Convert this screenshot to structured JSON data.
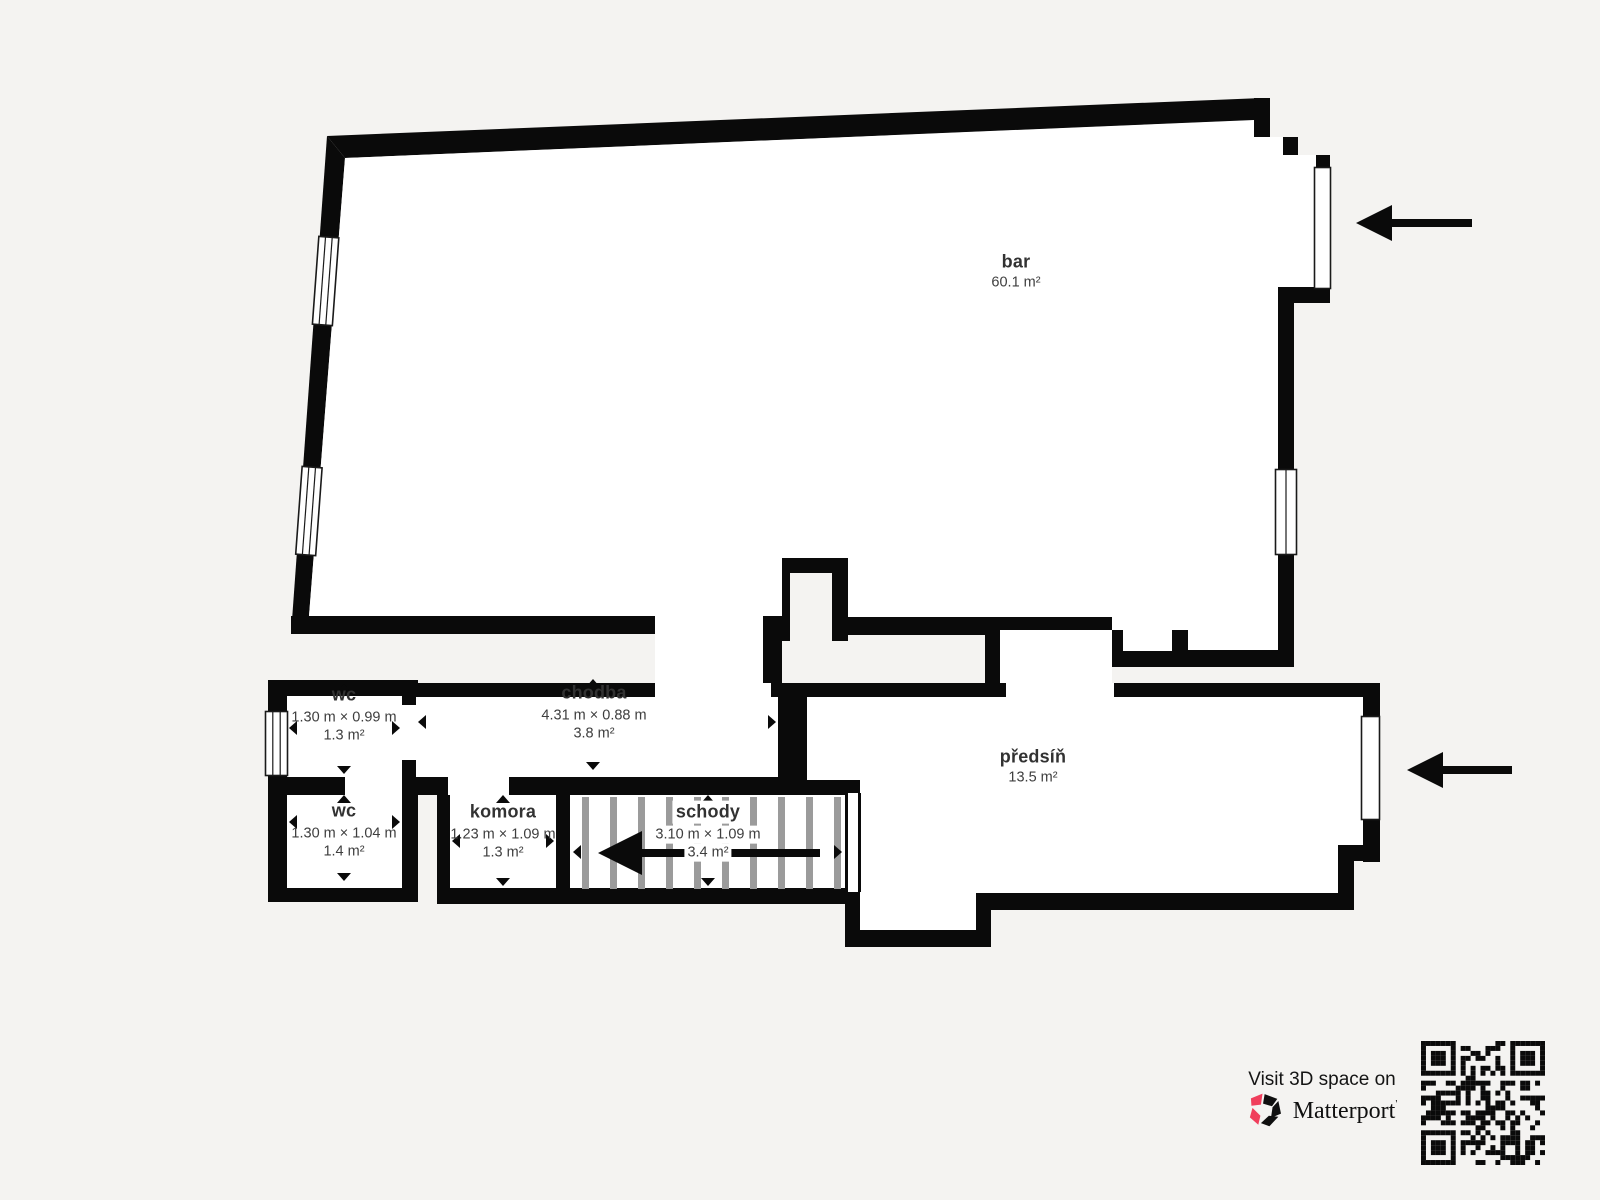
{
  "plan": {
    "rooms": {
      "bar": {
        "name": "bar",
        "area": "60.1 m²"
      },
      "chodba": {
        "name": "chodba",
        "dims": "4.31 m × 0.88 m",
        "area": "3.8 m²"
      },
      "wc_top": {
        "name": "wc",
        "dims": "1.30 m × 0.99 m",
        "area": "1.3 m²"
      },
      "wc_bottom": {
        "name": "wc",
        "dims": "1.30 m × 1.04 m",
        "area": "1.4 m²"
      },
      "komora": {
        "name": "komora",
        "dims": "1.23 m × 1.09 m",
        "area": "1.3 m²"
      },
      "schody": {
        "name": "schody",
        "dims": "3.10 m × 1.09 m",
        "area": "3.4 m²"
      },
      "predsin": {
        "name": "předsíň",
        "area": "13.5 m²"
      }
    }
  },
  "icons": {
    "entrance_arrow": "left-arrow",
    "measure_arrow": "small-triangle",
    "brand_logo": "matterport-pinwheel",
    "qr_code": "qr-code"
  },
  "footer": {
    "visit": "Visit 3D space on",
    "brand": "Matterport",
    "trademark": "'"
  },
  "colors": {
    "background": "#f4f3f1",
    "walls": "#0a0a0a",
    "room_fill": "#ffffff",
    "stair_tread": "#9b9b9b",
    "accent_pink": "#f03e5c",
    "text_primary": "#323232",
    "text_secondary": "#3e3e3e"
  }
}
